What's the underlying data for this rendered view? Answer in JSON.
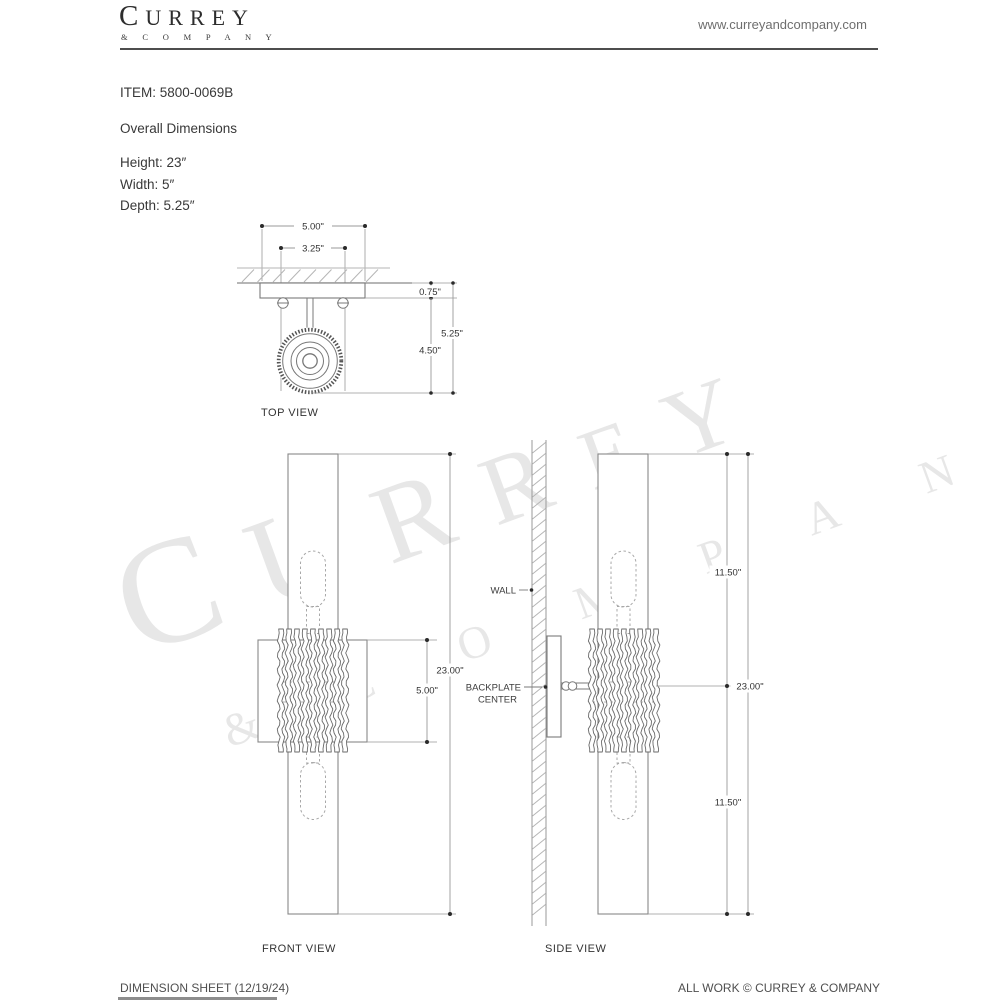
{
  "brand": {
    "logo_main": "CURREY",
    "logo_sub": "& C O M P A N Y",
    "website": "www.curreyandcompany.com"
  },
  "product": {
    "item_label": "ITEM: 5800-0069B",
    "section_title": "Overall Dimensions",
    "overall": {
      "height": "Height: 23″",
      "width": "Width: 5″",
      "depth": "Depth: 5.25″"
    }
  },
  "drawings": {
    "top_view": {
      "label": "TOP VIEW",
      "dim_width": "5.00\"",
      "dim_inner_width": "3.25\"",
      "dim_backplate_depth": "0.75\"",
      "dim_projection": "4.50\"",
      "dim_overall_depth": "5.25\""
    },
    "front_view": {
      "label": "FRONT VIEW",
      "dim_height": "23.00\"",
      "dim_backplate": "5.00\""
    },
    "side_view": {
      "label": "SIDE VIEW",
      "wall_label": "WALL",
      "backplate_label_line1": "BACKPLATE",
      "backplate_label_line2": "CENTER",
      "dim_upper": "11.50\"",
      "dim_lower": "11.50\"",
      "dim_height": "23.00\""
    }
  },
  "watermark": {
    "line1": "CURREY",
    "line2": "& C O M P A N Y"
  },
  "footer": {
    "left": "DIMENSION SHEET (12/19/24)",
    "right": "ALL WORK © CURREY & COMPANY"
  },
  "colors": {
    "object_line": "#7a7a7a",
    "dim_line": "#999999",
    "hatch": "#b5b5b5",
    "rule": "#4d4d4d"
  }
}
